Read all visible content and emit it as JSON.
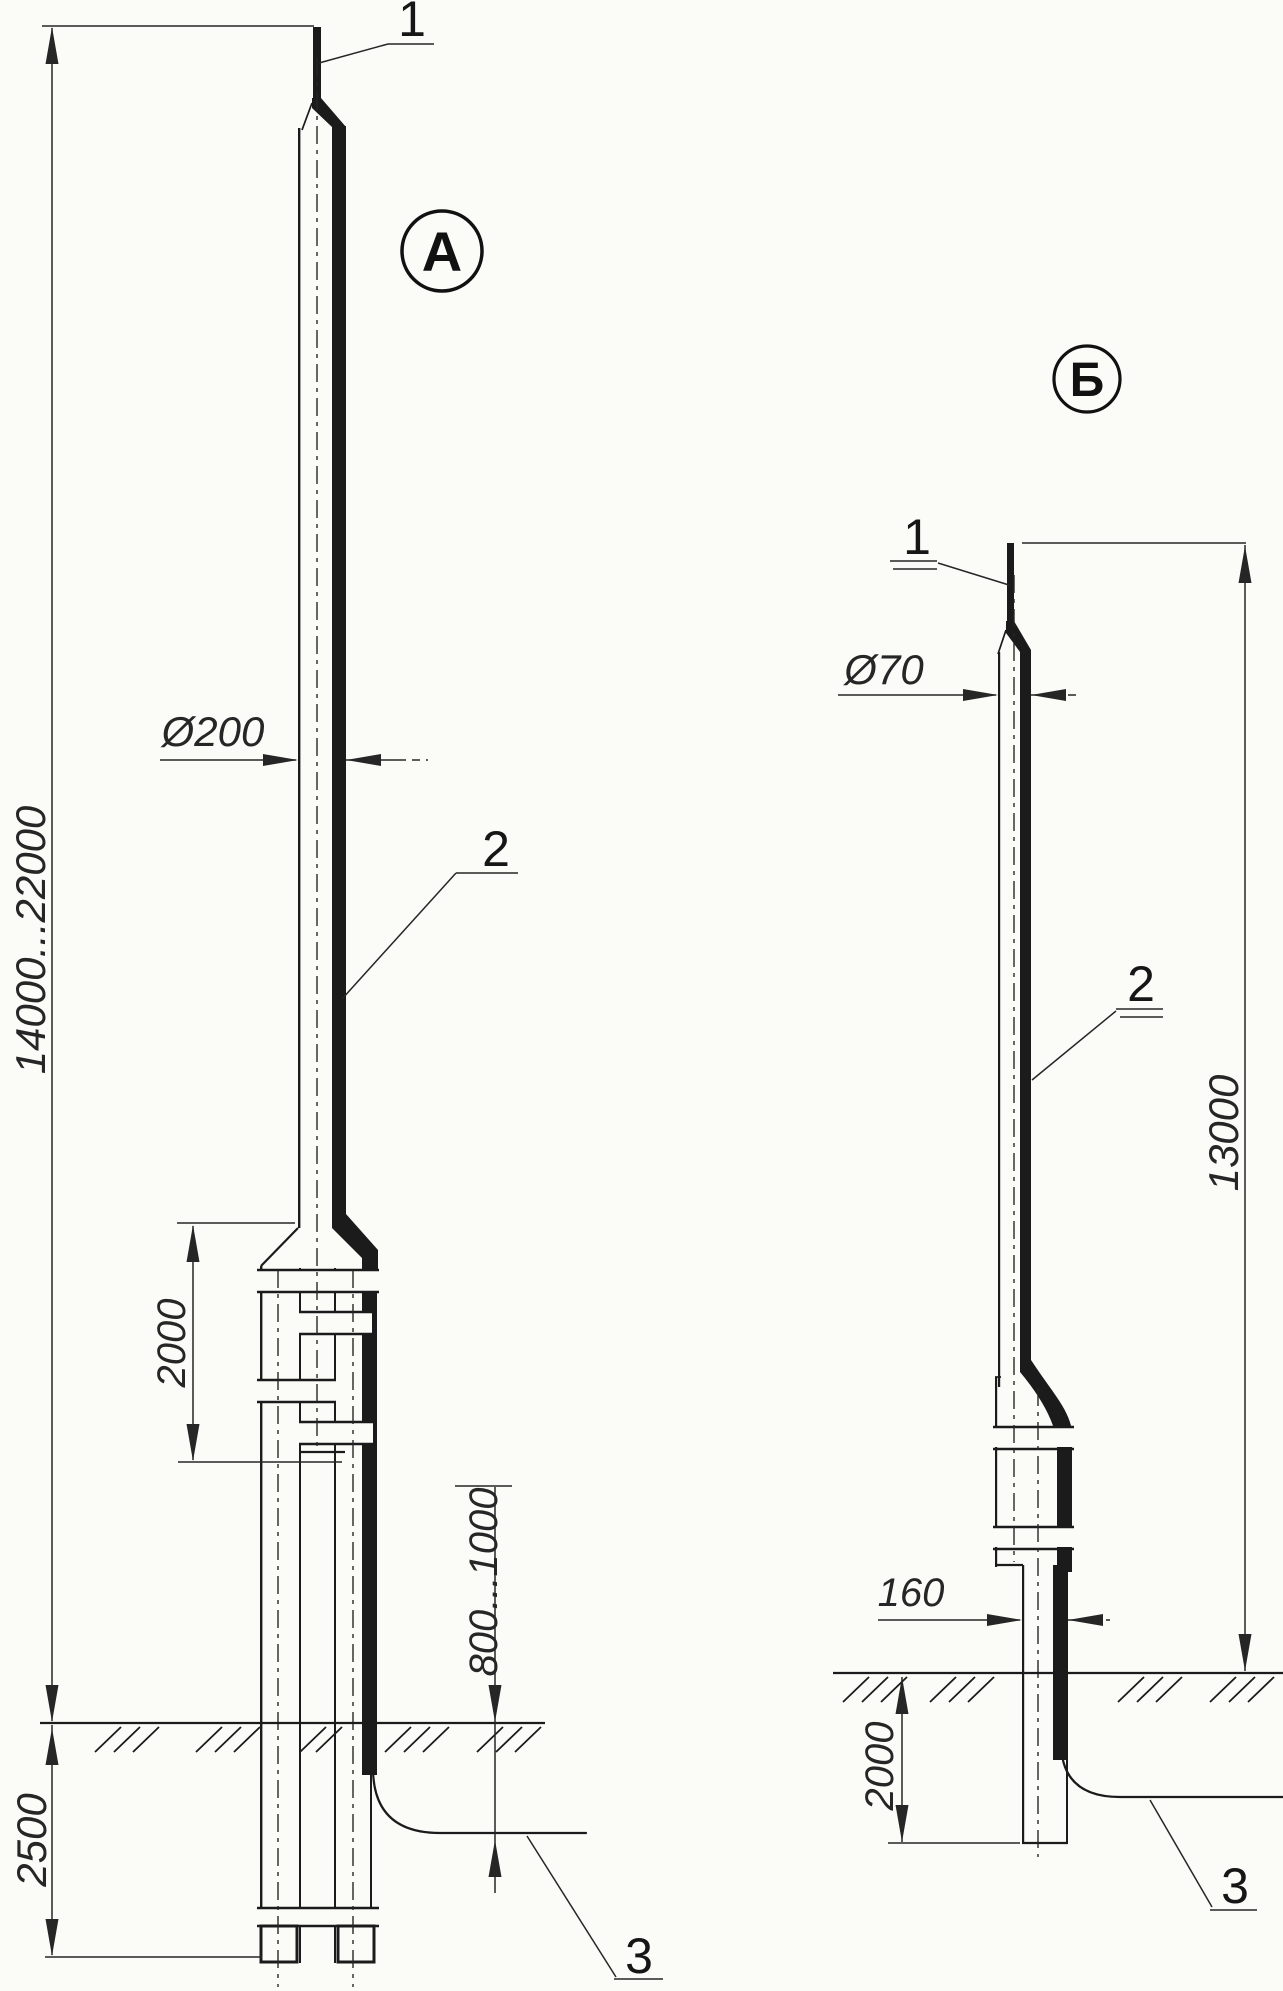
{
  "colors": {
    "ink": "#1b1b1b",
    "dim": "#262626",
    "paper": "#fbfbf8"
  },
  "variant_a": {
    "badge": "А",
    "callout_1": "1",
    "callout_2": "2",
    "callout_3": "3",
    "dim_height": "14000...22000",
    "dim_diameter": "Ø200",
    "dim_overlap": "2000",
    "dim_cable_depth": "800...1000",
    "dim_underground": "2500"
  },
  "variant_b": {
    "badge": "Б",
    "callout_1": "1",
    "callout_2": "2",
    "callout_3": "3",
    "dim_height": "13000",
    "dim_diameter": "Ø70",
    "dim_base": "160",
    "dim_underground": "2000"
  }
}
